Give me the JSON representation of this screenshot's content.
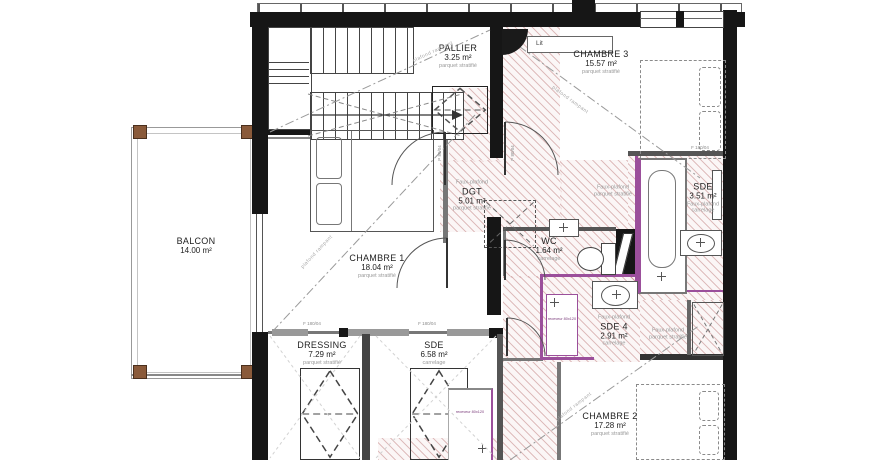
{
  "rooms": [
    {
      "name": "PALLIER",
      "area": "3.25 m²",
      "material": "parquet stratifié"
    },
    {
      "name": "CHAMBRE 3",
      "area": "15.57 m²",
      "material": "parquet stratifié"
    },
    {
      "name": "DGT",
      "area": "5.01 m²",
      "material": "parquet stratifié",
      "ceiling": "Faux-plafond"
    },
    {
      "name": "SDE",
      "area": "3.51 m²",
      "ceiling": "Faux-plafond",
      "material": "carrelage"
    },
    {
      "name": "WC",
      "area": "1.64 m²",
      "material": "carrelage"
    },
    {
      "name": "CHAMBRE 1",
      "area": "18.04 m²",
      "material": "parquet stratifié"
    },
    {
      "name": "BALCON",
      "area": "14.00 m²"
    },
    {
      "name": "SDE 4",
      "area": "2.91 m²",
      "ceiling": "Faux-plafond",
      "material": "carrelage"
    },
    {
      "name": "DRESSING",
      "area": "7.29 m²",
      "material": "parquet stratifié"
    },
    {
      "name": "SDE",
      "area": "6.58 m²",
      "material": "carrelage"
    },
    {
      "name": "CHAMBRE 2",
      "area": "17.28 m²",
      "material": "parquet stratifié"
    }
  ],
  "notes": {
    "faux_plafond": "Faux-plafond",
    "parquet": "parquet stratifié",
    "slope": "plafond rampant",
    "bed": "Lit",
    "shower": "receveur 80x120",
    "door": "P 80/04",
    "window": "F 180/04"
  },
  "colors": {
    "wall": "#161616",
    "fixture_accent": "#9b4f9b",
    "hatch_line": "#dfb8b8",
    "wood_post": "#8a5a3a"
  }
}
